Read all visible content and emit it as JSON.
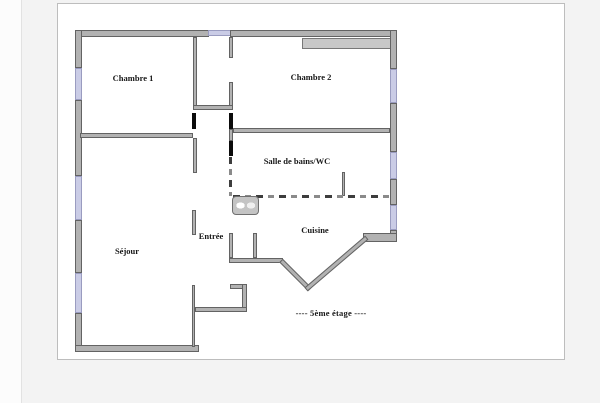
{
  "page": {
    "background": "#f3f3f3",
    "panel_background": "#ffffff",
    "panel_border": "#bdbdbd"
  },
  "palette": {
    "wall_fill": "#b2b2b2",
    "wall_border": "#636363",
    "window_fill": "#cacce6",
    "door_mark": "#0b0b0b",
    "label_color": "#181818"
  },
  "floorplan": {
    "floor_note": "----  5ème étage  ----",
    "floor_note_pos": {
      "cx": 331,
      "y": 308
    },
    "rooms": [
      {
        "id": "chambre1",
        "label": "Chambre 1",
        "cx": 133,
        "y": 73
      },
      {
        "id": "chambre2",
        "label": "Chambre 2",
        "cx": 311,
        "y": 72
      },
      {
        "id": "salle-de-bains",
        "label": "Salle de bains/WC",
        "cx": 297,
        "y": 156
      },
      {
        "id": "sejour",
        "label": "Séjour",
        "cx": 127,
        "y": 246
      },
      {
        "id": "entree",
        "label": "Entrée",
        "cx": 211,
        "y": 231
      },
      {
        "id": "cuisine",
        "label": "Cuisine",
        "cx": 315,
        "y": 225
      }
    ],
    "walls": [
      {
        "name": "top-wall-left",
        "kind": "wall",
        "x": 75,
        "y": 30,
        "w": 134,
        "h": 7
      },
      {
        "name": "top-wall-window",
        "kind": "window",
        "x": 208,
        "y": 30,
        "w": 23,
        "h": 6
      },
      {
        "name": "top-wall-right",
        "kind": "wall",
        "x": 230,
        "y": 30,
        "w": 167,
        "h": 7
      },
      {
        "name": "chambre2-closet",
        "kind": "closet",
        "x": 302,
        "y": 38,
        "w": 90,
        "h": 11
      },
      {
        "name": "right-wall-1",
        "kind": "wall",
        "x": 390,
        "y": 30,
        "w": 7,
        "h": 39
      },
      {
        "name": "right-wall-window-1",
        "kind": "window",
        "x": 390,
        "y": 69,
        "w": 7,
        "h": 34
      },
      {
        "name": "right-wall-2",
        "kind": "wall",
        "x": 390,
        "y": 103,
        "w": 7,
        "h": 49
      },
      {
        "name": "right-wall-window-2",
        "kind": "window",
        "x": 390,
        "y": 152,
        "w": 7,
        "h": 27
      },
      {
        "name": "right-wall-3",
        "kind": "wall",
        "x": 390,
        "y": 179,
        "w": 7,
        "h": 26
      },
      {
        "name": "right-wall-window-3",
        "kind": "window",
        "x": 390,
        "y": 205,
        "w": 7,
        "h": 25
      },
      {
        "name": "right-wall-corner",
        "kind": "wall",
        "x": 390,
        "y": 230,
        "w": 7,
        "h": 12
      },
      {
        "name": "left-wall-1",
        "kind": "wall",
        "x": 75,
        "y": 30,
        "w": 7,
        "h": 38
      },
      {
        "name": "left-wall-window-1",
        "kind": "window",
        "x": 75,
        "y": 68,
        "w": 7,
        "h": 32
      },
      {
        "name": "left-wall-2",
        "kind": "wall",
        "x": 75,
        "y": 100,
        "w": 7,
        "h": 76
      },
      {
        "name": "left-wall-window-2",
        "kind": "window",
        "x": 75,
        "y": 176,
        "w": 7,
        "h": 44
      },
      {
        "name": "left-wall-3",
        "kind": "wall",
        "x": 75,
        "y": 220,
        "w": 7,
        "h": 53
      },
      {
        "name": "left-wall-window-3",
        "kind": "window",
        "x": 75,
        "y": 273,
        "w": 7,
        "h": 40
      },
      {
        "name": "left-wall-4",
        "kind": "wall",
        "x": 75,
        "y": 313,
        "w": 7,
        "h": 39
      },
      {
        "name": "bottom-wall",
        "kind": "wall",
        "x": 75,
        "y": 345,
        "w": 124,
        "h": 7
      },
      {
        "name": "vestibule-left-wall",
        "kind": "wall",
        "x": 193,
        "y": 37,
        "w": 4,
        "h": 73
      },
      {
        "name": "vestibule-right-wall-top",
        "kind": "wall",
        "x": 229,
        "y": 37,
        "w": 4,
        "h": 21
      },
      {
        "name": "vestibule-right-wall-bot",
        "kind": "wall",
        "x": 229,
        "y": 82,
        "w": 4,
        "h": 28
      },
      {
        "name": "vestibule-bottom-wall",
        "kind": "wall",
        "x": 193,
        "y": 105,
        "w": 40,
        "h": 5
      },
      {
        "name": "chambre1-sejour-wall",
        "kind": "wall",
        "x": 80,
        "y": 133,
        "w": 113,
        "h": 5
      },
      {
        "name": "sejour-hall-wall",
        "kind": "wall",
        "x": 193,
        "y": 138,
        "w": 4,
        "h": 35
      },
      {
        "name": "chambre2-bath-wall",
        "kind": "wall",
        "x": 233,
        "y": 128,
        "w": 157,
        "h": 5
      },
      {
        "name": "hall-bath-pier",
        "kind": "wall",
        "x": 229,
        "y": 129,
        "w": 4,
        "h": 12
      },
      {
        "name": "entree-left-stub",
        "kind": "wall",
        "x": 192,
        "y": 210,
        "w": 4,
        "h": 25
      },
      {
        "name": "sejour-right-wall",
        "kind": "wall",
        "x": 192,
        "y": 285,
        "w": 3,
        "h": 62
      },
      {
        "name": "kitchen-door-left-wall",
        "kind": "wall",
        "x": 229,
        "y": 233,
        "w": 4,
        "h": 25
      },
      {
        "name": "kitchen-door-right-wall",
        "kind": "wall",
        "x": 253,
        "y": 233,
        "w": 4,
        "h": 25
      },
      {
        "name": "entree-kitchen-wall",
        "kind": "wall",
        "x": 229,
        "y": 258,
        "w": 54,
        "h": 5
      },
      {
        "name": "entree-step-top-wall",
        "kind": "wall",
        "x": 230,
        "y": 284,
        "w": 17,
        "h": 5
      },
      {
        "name": "entree-step-right-wall",
        "kind": "wall",
        "x": 242,
        "y": 284,
        "w": 5,
        "h": 28
      },
      {
        "name": "entree-step-bottom-wall",
        "kind": "wall",
        "x": 195,
        "y": 307,
        "w": 52,
        "h": 5
      },
      {
        "name": "kitchen-bay-ledge",
        "kind": "wall",
        "x": 363,
        "y": 233,
        "w": 34,
        "h": 9
      },
      {
        "name": "bathroom-stub-wall",
        "kind": "wall",
        "x": 342,
        "y": 172,
        "w": 3,
        "h": 24
      },
      {
        "name": "door-opening-chambre1",
        "kind": "door",
        "x": 192,
        "y": 113,
        "w": 4,
        "h": 16
      },
      {
        "name": "door-opening-chambre2",
        "kind": "door",
        "x": 229,
        "y": 113,
        "w": 4,
        "h": 16
      },
      {
        "name": "door-opening-bathroom",
        "kind": "door",
        "x": 229,
        "y": 141,
        "w": 4,
        "h": 15
      },
      {
        "name": "bath-hall-dashed-wall",
        "kind": "dashed-v",
        "x": 229,
        "y": 157,
        "w": 3,
        "h": 39
      },
      {
        "name": "bath-kitchen-dashed-wall",
        "kind": "dashed-h",
        "x": 233,
        "y": 195,
        "w": 159,
        "h": 3
      }
    ],
    "diagonal_walls": [
      {
        "name": "kitchen-bay-wall-left",
        "x": 281,
        "y": 258,
        "length": 41,
        "angle": 45
      },
      {
        "name": "kitchen-bay-wall-right",
        "x": 306,
        "y": 287,
        "length": 80,
        "angle": -40.5
      }
    ],
    "fixtures": [
      {
        "name": "washbasin",
        "x": 232,
        "y": 196,
        "w": 25,
        "h": 17
      }
    ]
  }
}
